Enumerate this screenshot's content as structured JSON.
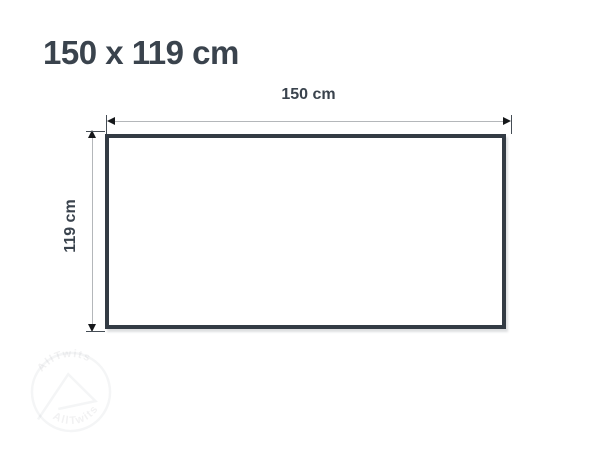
{
  "title": {
    "text": "150 x 119 cm"
  },
  "diagram": {
    "width_label": "150 cm",
    "height_label": "119 cm",
    "shape": "rectangle"
  },
  "watermark": {
    "text_top": "AllTwits",
    "text_bottom": "AllTwits"
  },
  "colors": {
    "text": "#3a434d",
    "rect_border": "#333b44",
    "dim_line": "#b4b7ba",
    "tick": "#454d55",
    "arrow": "#16181b",
    "bg": "#ffffff"
  }
}
